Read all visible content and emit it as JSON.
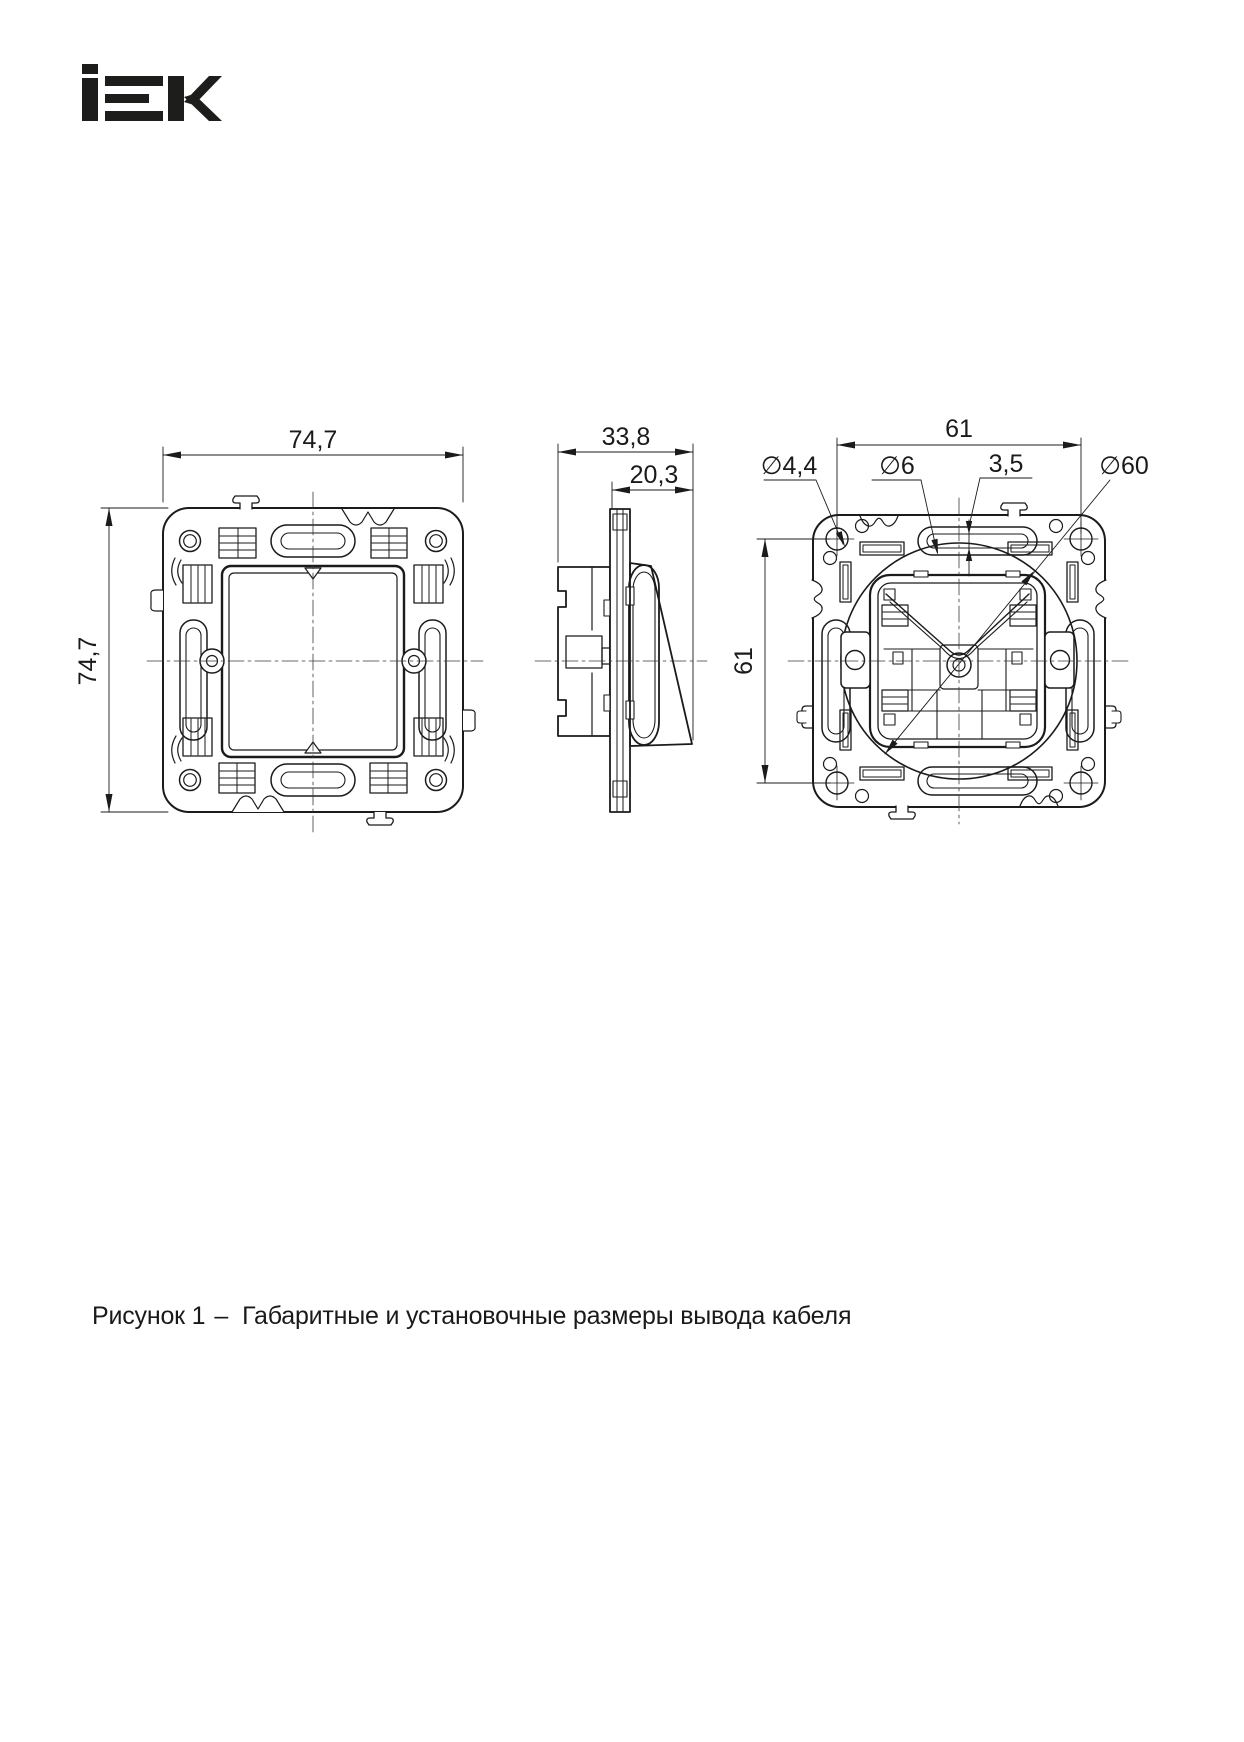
{
  "logo": {
    "name": "IEK"
  },
  "drawing": {
    "front": {
      "width": "74,7",
      "height": "74,7"
    },
    "side": {
      "depth_total": "33,8",
      "depth_mount": "20,3"
    },
    "rear": {
      "hole_spacing_h": "61",
      "hole_spacing_v": "61",
      "screw_hole_dia": "∅4,4",
      "slot_hole_dia": "∅6",
      "slot_width": "3,5",
      "body_dia": "∅60"
    }
  },
  "caption": {
    "figure_label": "Рисунок 1",
    "separator": "–",
    "text": "Габаритные и установочные размеры вывода кабеля"
  }
}
